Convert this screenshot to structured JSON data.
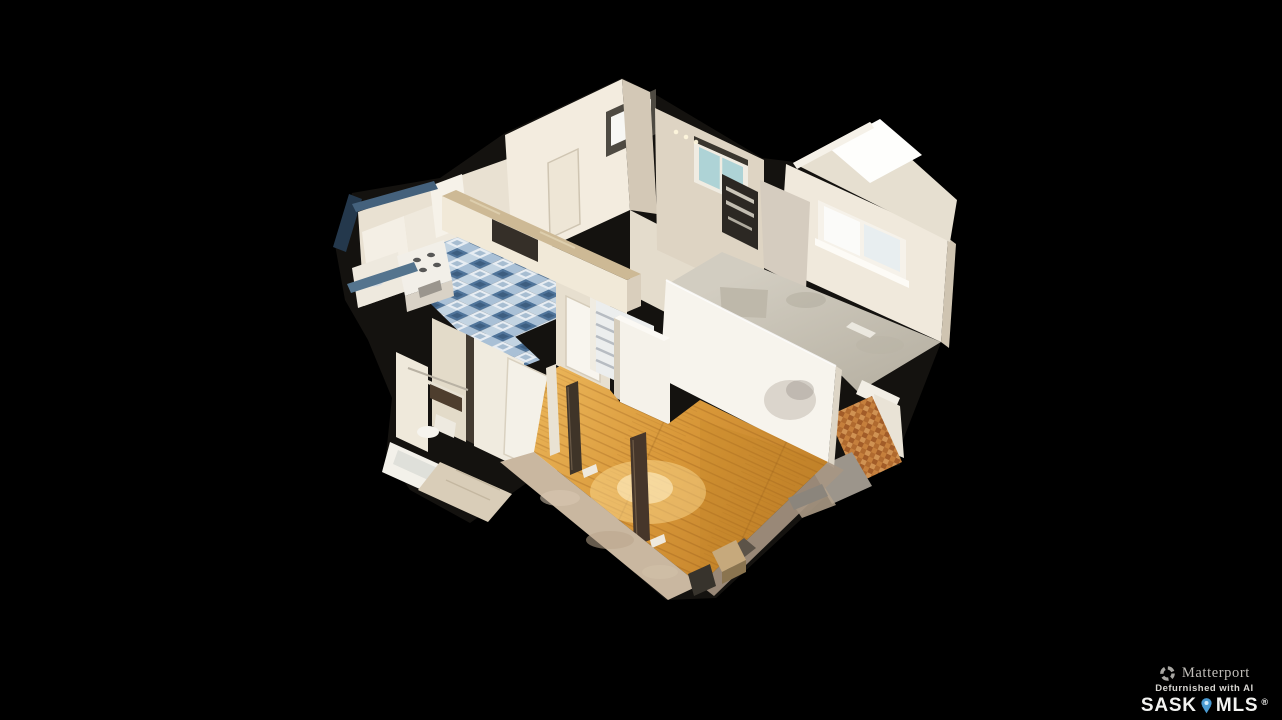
{
  "scene": {
    "view": "3d-dollhouse-floor-model",
    "background": "#000000",
    "rooms": [
      {
        "label": "kitchen",
        "floor": "blue checkered tile"
      },
      {
        "label": "hallway",
        "feature": "staircase"
      },
      {
        "label": "bathroom",
        "floor": "beige tile"
      },
      {
        "label": "living-room",
        "floor": "golden hardwood"
      },
      {
        "label": "bedroom",
        "floor": "grey-beige carpet"
      }
    ],
    "colors": {
      "hardwood": "#d89a3e",
      "kitchen_tile_blue": "#4f749a",
      "carpet": "#c7c2b6",
      "walls_bright": "#f3ecdf",
      "walls_shaded": "#d9cfc0",
      "slab_edge_tan": "#c9b7a0",
      "exterior_cut_navy": "#24384c"
    }
  },
  "watermark": {
    "brand": "Matterport",
    "tagline": "Defurnished with AI",
    "mls_left": "SASK",
    "mls_right": "MLS",
    "registered_mark": "®",
    "pin_color": "#4a9ad2",
    "text_color": "#f3f3f1"
  }
}
